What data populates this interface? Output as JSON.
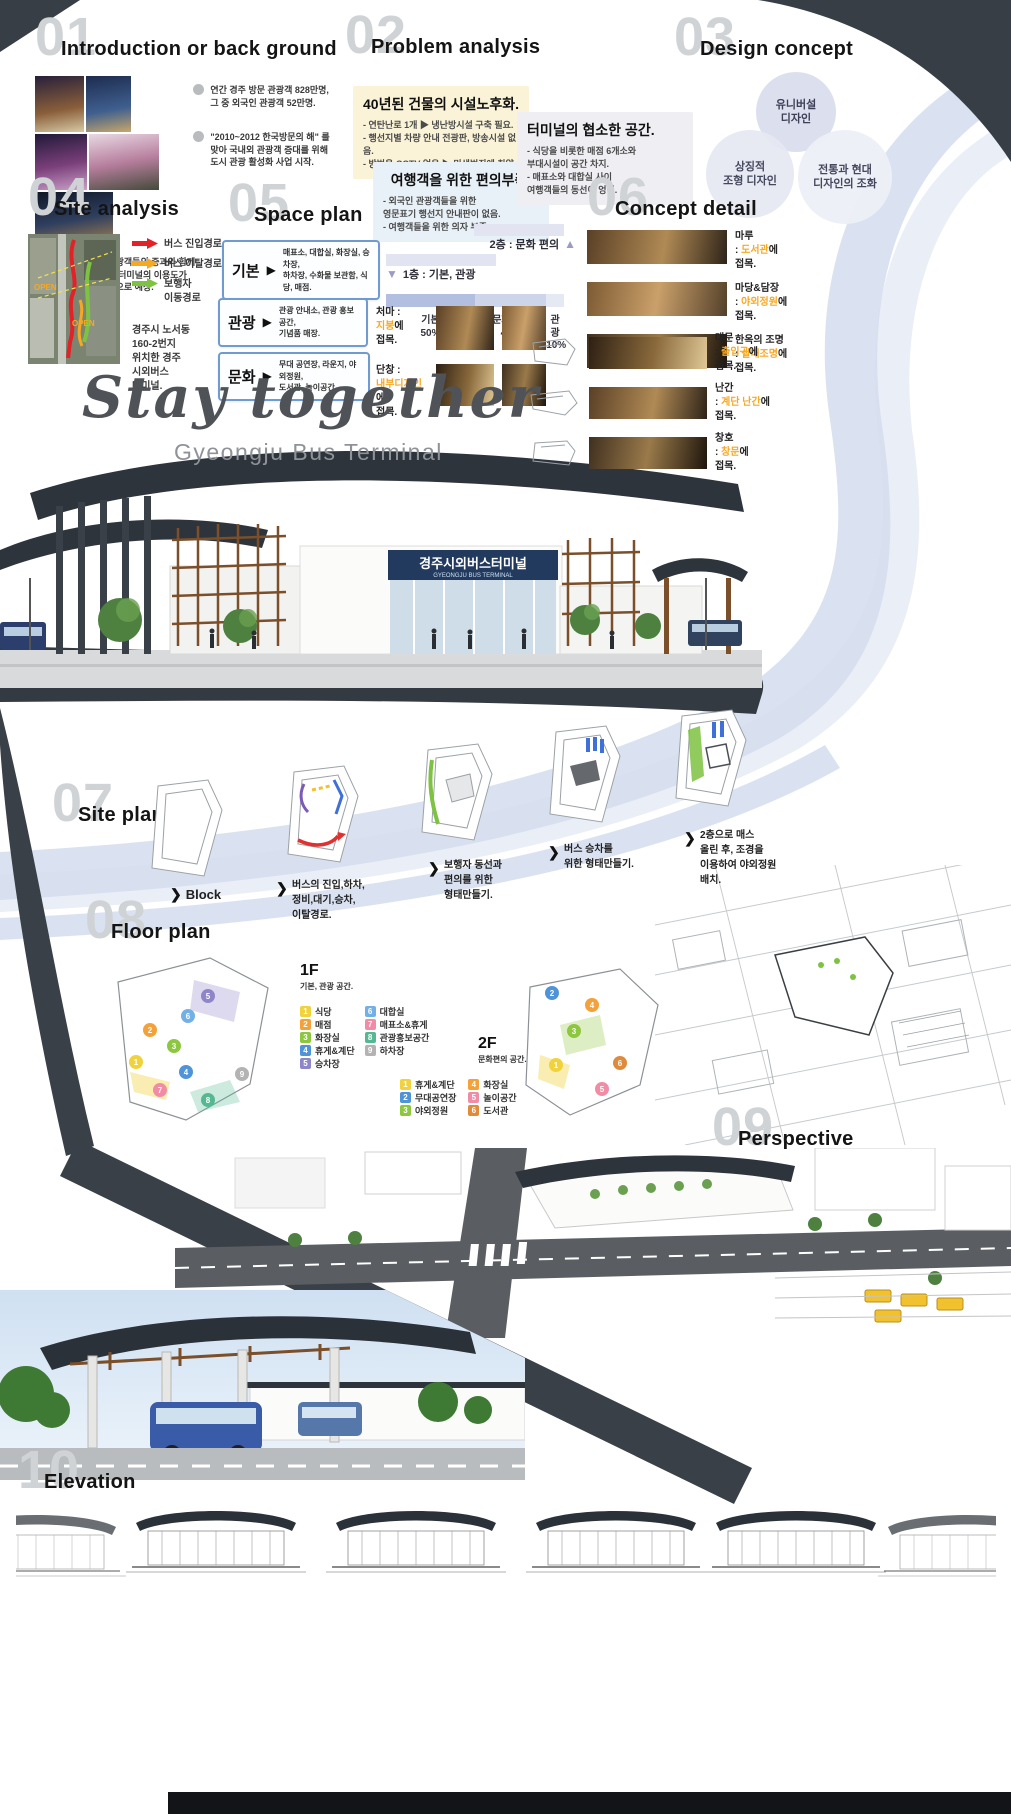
{
  "palette": {
    "dark_band": "#383e45",
    "ribbon_blue": "#bccae6",
    "accent_orange": "#f7a823",
    "box_border_blue": "#6f9bd1"
  },
  "hero": {
    "title": "Stay together",
    "subtitle": "Gyeongju Bus Terminal",
    "sign_ko": "경주시외버스터미널",
    "sign_en": "GYEONGJU BUS TERMINAL"
  },
  "s01": {
    "num": "01",
    "title": "Introduction or back ground",
    "bullets": [
      "연간 경주 방문 관광객 828만명,\n그 중 외국인 관광객 52만명.",
      "\"2010~2012 한국방문의 해\" 를\n맞아 국내외 관광객 증대를 위해\n도시 관광 활성화 사업 시작.",
      "국내외 관광객들의 증과와 함께\n경주 버스 터미널의 이용도가\n높아질 것으로 예상."
    ]
  },
  "s02": {
    "num": "02",
    "title": "Problem analysis",
    "cards": [
      {
        "title": "40년된 건물의 시설노후화.",
        "bg": "#faf3d8",
        "items": [
          "- 연탄난로 1개 ▶ 냉난방시설 구축 필요.",
          "- 행선지별 차량 안내 전광판, 방송시설 없음.",
          "- 방범용 CCTV 없음 ▶ 민생범죄에 취약."
        ]
      },
      {
        "title": "여행객을 위한 편의부족.",
        "bg": "#e9f1f8",
        "items": [
          "- 외국인 관광객들을 위한\n  영문표기 행선지 안내판이 없음.",
          "- 여행객들을 위한 의자 부족."
        ]
      },
      {
        "title": "터미널의 협소한 공간.",
        "bg": "#efeef3",
        "items": [
          "- 식당을 비롯한 매점 6개소와\n  부대시설이 공간 차지.",
          "- 매표소와 대합실 사이\n  여행객들의 동선이 엉킴."
        ]
      }
    ]
  },
  "s03": {
    "num": "03",
    "title": "Design concept",
    "circles": [
      "유니버설\n디자인",
      "상징적\n조형 디자인",
      "전통과 현대\n디자인의 조화"
    ]
  },
  "s04": {
    "num": "04",
    "title": "Site analysis",
    "legend": [
      {
        "label": "버스 진입경로",
        "color": "#e32127"
      },
      {
        "label": "버스 이탈경로",
        "color": "#f7a823"
      },
      {
        "label": "보행자\n이동경로",
        "color": "#7ec242"
      }
    ],
    "map_labels": [
      "OPEN",
      "OPEN"
    ],
    "caption": "경주시 노서동\n160-2번지\n위치한 경주\n시외버스\n터미널."
  },
  "s05": {
    "num": "05",
    "title": "Space plan",
    "arrow": "▶",
    "rows": [
      {
        "label": "기본",
        "desc": "매표소, 대합실, 화장실, 승차장,\n하차장, 수화물 보관함, 식당, 매점."
      },
      {
        "label": "관광",
        "desc": "관광 안내소, 관광 홍보 공간,\n기념품 매장."
      },
      {
        "label": "문화",
        "desc": "무대 공연장, 라운지, 야외정원,\n도서관, 놀이공간."
      }
    ],
    "levels": [
      {
        "label": "2층 : 문화 편의",
        "arrow": "▲"
      },
      {
        "label": "1층 : 기본, 관광",
        "arrow": "▼"
      }
    ],
    "bar": [
      {
        "label": "기본",
        "pct": "50%",
        "width": "50%",
        "color": "#b3bfe0"
      },
      {
        "label": "문화편의",
        "pct": "40%",
        "width": "40%",
        "color": "#ccd5ea"
      },
      {
        "label": "관광",
        "pct": "10%",
        "width": "10%",
        "color": "#e4e9f4"
      }
    ],
    "details": [
      {
        "name": "처마 :",
        "hl": "지붕"
      },
      {
        "name": "단창 :",
        "hl": "내부디자인"
      }
    ],
    "suffix": "에",
    "verb": "접목."
  },
  "s06": {
    "num": "06",
    "title": "Concept detail",
    "colon": ":",
    "suffix": "에",
    "verb": "접목.",
    "items_left": [
      {
        "name": "마루",
        "hl": "도서관"
      },
      {
        "name": "마당&담장",
        "hl": "야외정원"
      },
      {
        "name": "한옥의 조명",
        "hl": "실내조명"
      }
    ],
    "items_right": [
      {
        "name": "대문",
        "hl": "출입구"
      },
      {
        "name": "난간",
        "hl": "계단 난간"
      },
      {
        "name": "창호",
        "hl": "창문"
      }
    ]
  },
  "s07": {
    "num": "07",
    "title": "Site plan",
    "chevron": "❯",
    "steps": [
      "Block",
      "버스의 진입,하차,\n정비,대기,승차,\n이탈경로.",
      "보행자 동선과\n편의를 위한\n형태만들기.",
      "버스 승차를\n위한 형태만들기.",
      "2층으로 매스\n올린 후, 조경을\n이용하여 야외정원\n배치."
    ]
  },
  "s08": {
    "num": "08",
    "title": "Floor plan",
    "f1": {
      "name": "1F",
      "sub": "기본, 관광 공간.",
      "markers": [
        "5",
        "6",
        "2",
        "3",
        "1",
        "4",
        "7",
        "8",
        "9"
      ],
      "legend": [
        {
          "n": "1",
          "label": "식당",
          "color": "#f0d23c"
        },
        {
          "n": "2",
          "label": "매점",
          "color": "#f5a13a"
        },
        {
          "n": "3",
          "label": "화장실",
          "color": "#8dc63f"
        },
        {
          "n": "4",
          "label": "휴게&계단",
          "color": "#4f94d8"
        },
        {
          "n": "5",
          "label": "승차장",
          "color": "#8f86c9"
        },
        {
          "n": "6",
          "label": "대합실",
          "color": "#74b0e8"
        },
        {
          "n": "7",
          "label": "매표소&휴게",
          "color": "#f08ca6"
        },
        {
          "n": "8",
          "label": "관광홍보공간",
          "color": "#55b893"
        },
        {
          "n": "9",
          "label": "하차장",
          "color": "#b3b3b3"
        }
      ]
    },
    "f2": {
      "name": "2F",
      "sub": "문화편의 공간.",
      "markers": [
        "2",
        "4",
        "3",
        "1",
        "6",
        "5"
      ],
      "legend": [
        {
          "n": "1",
          "label": "휴게&계단",
          "color": "#f0d23c"
        },
        {
          "n": "2",
          "label": "무대공연장",
          "color": "#4f94d8"
        },
        {
          "n": "3",
          "label": "야외정원",
          "color": "#8dc63f"
        },
        {
          "n": "4",
          "label": "화장실",
          "color": "#f5a13a"
        },
        {
          "n": "5",
          "label": "놀이공간",
          "color": "#f08ca6"
        },
        {
          "n": "6",
          "label": "도서관",
          "color": "#e08a3c"
        }
      ]
    }
  },
  "s09": {
    "num": "09",
    "title": "Perspective"
  },
  "s10": {
    "num": "10",
    "title": "Elevation"
  }
}
